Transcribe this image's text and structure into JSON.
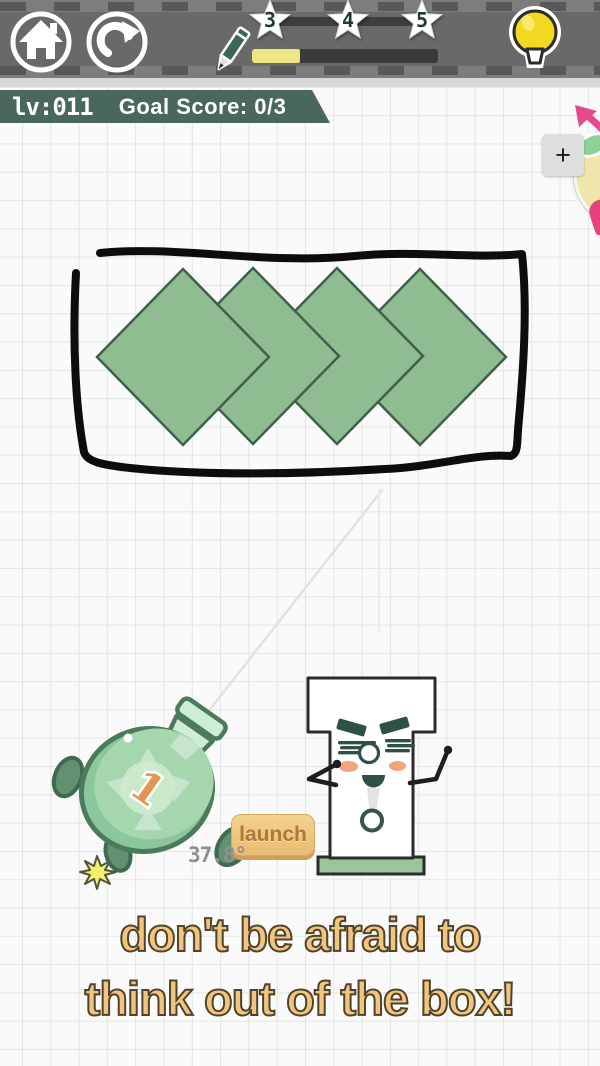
{
  "topbar": {
    "progress_percent": 26,
    "stars": [
      {
        "label": "3"
      },
      {
        "label": "4"
      },
      {
        "label": "5"
      }
    ]
  },
  "level": {
    "label": "lv:011",
    "goal": "Goal Score: 0/3"
  },
  "hud": {
    "plus": "+"
  },
  "game": {
    "launch": "launch",
    "angle": "37.8°",
    "bomb_count": "1"
  },
  "hint": {
    "line1": "don't be afraid to",
    "line2": "think out of the box!"
  },
  "colors": {
    "badge_green": "#4a675e",
    "progress_yellow": "#ece783",
    "bulb_yellow": "#f3d822",
    "diamond_green": "#8fbc90",
    "bomb_green": "#a5d6ad",
    "launch_orange": "#e9bd72",
    "hint_tan": "#efc67d",
    "blush_pink": "#f2a381",
    "wheel_pink": "#e8417d"
  }
}
